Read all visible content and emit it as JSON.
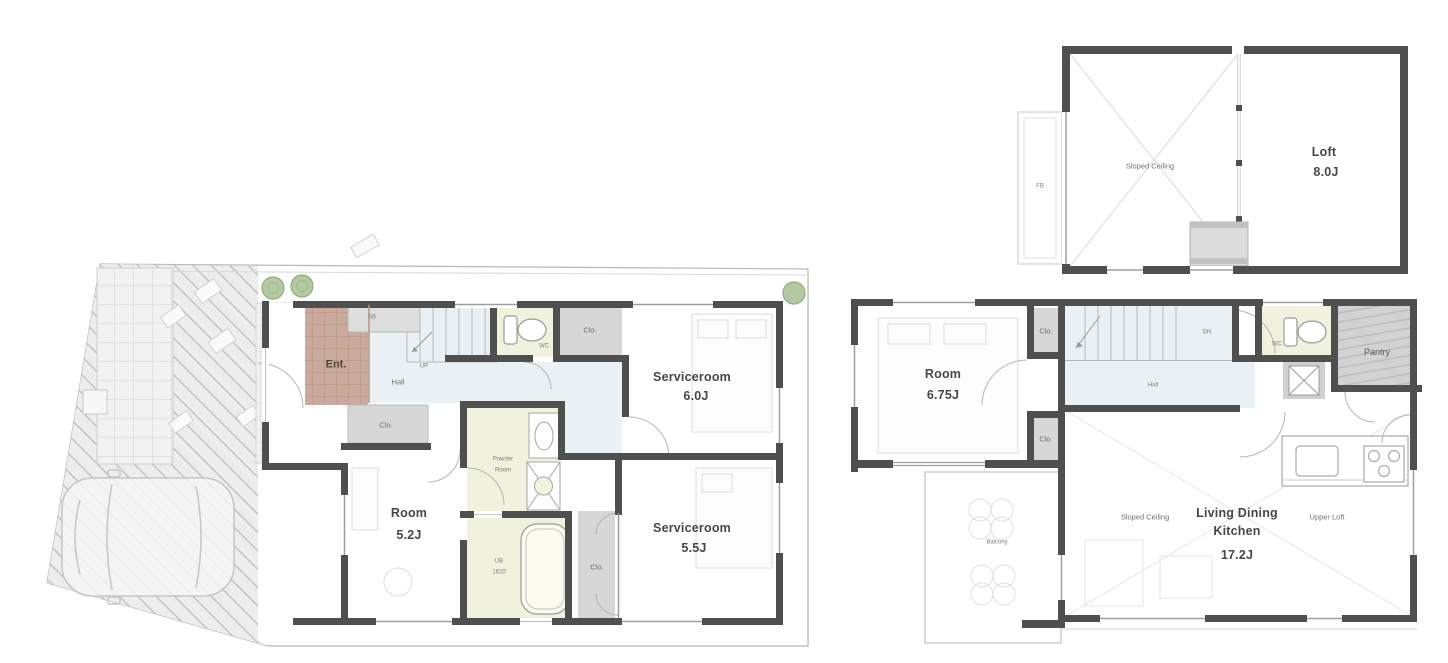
{
  "colors": {
    "wall": "#4f4f4f",
    "closet_fill": "#d7d7d7",
    "entrance_tile": "#c9aa9c",
    "hall_fill": "#eaf1f5",
    "wet_room_fill": "#f1f2de",
    "pantry_fill": "#cdcdcd",
    "driveway_fill": "#ececec",
    "tree_fill": "#b3c9a2",
    "label_text": "#474747"
  },
  "first_floor": {
    "entrance_label": "Ent.",
    "hall_label": "Hall",
    "stairs_label": "UP",
    "shoe_cabinet_label": "SB",
    "wc_label": "WC",
    "closet_top_label": "Clo.",
    "closet_mid_label": "Clo.",
    "closet_bath_label": "Clo.",
    "serviceroom_large": {
      "name": "Serviceroom",
      "area": "6.0J"
    },
    "serviceroom_small": {
      "name": "Serviceroom",
      "area": "5.5J"
    },
    "room": {
      "name": "Room",
      "area": "5.2J"
    },
    "powder_room": {
      "line1": "Powder",
      "line2": "Room"
    },
    "bath": {
      "line1": "UB",
      "line2": "1620"
    }
  },
  "second_floor": {
    "room": {
      "name": "Room",
      "area": "6.75J"
    },
    "closet_top_label": "Clo.",
    "closet_bottom_label": "Clo.",
    "stairs_label": "DN",
    "hall_label": "Hall",
    "wc_label": "WC",
    "pantry_label": "Pantry",
    "sloped_ceiling_label": "Sloped Ceiling",
    "ldk": {
      "line1": "Living Dining",
      "line2": "Kitchen",
      "area": "17.2J"
    },
    "upper_loft_label": "Upper Loft",
    "balcony_label": "Balcony"
  },
  "loft": {
    "room": {
      "name": "Loft",
      "area": "8.0J"
    },
    "sloped_ceiling_label": "Sloped Ceiling",
    "window_label": "FB"
  }
}
